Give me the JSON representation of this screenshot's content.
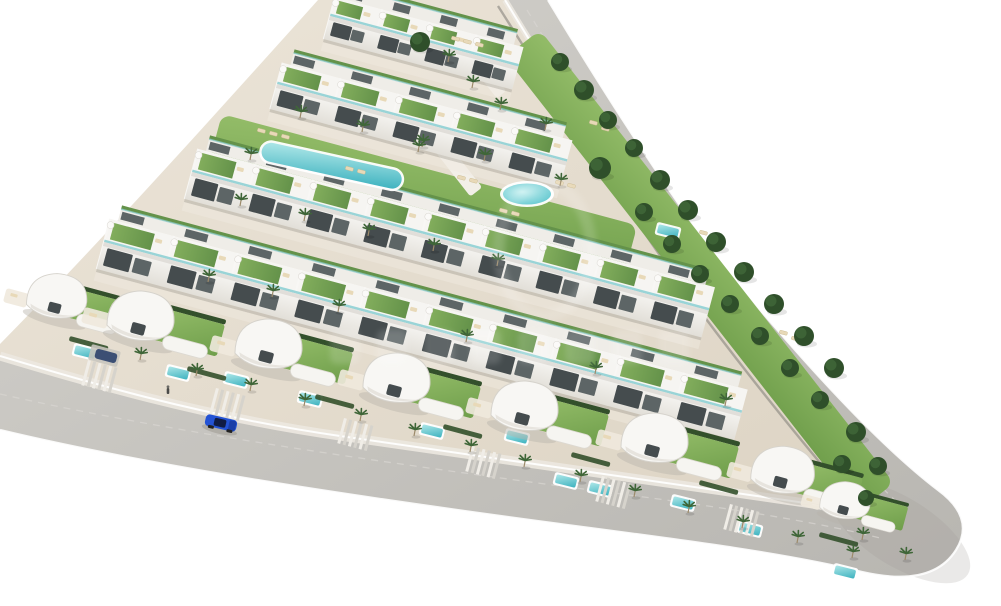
{
  "scene": {
    "description": "Aerial 3D architectural render of a triangular coastal residential development: stepped rows of white townhouses with green roof terraces and glass balustrades, a curved communal lap pool and a round pool on lawns, curvy white detached villas with private pools along the lower rows, palm trees, dense green trees along the upper perimeter road, two gray roads meeting at a rounded eastern tip, one blue car driving on the lower road, faint illegible watermark in the center.",
    "background": "#ffffff",
    "width": 1001,
    "height": 606
  },
  "colors": {
    "sand1": "#ece5d9",
    "sand2": "#ddd4c4",
    "road1": "#d4d2cd",
    "road2": "#b8b6b1",
    "roadDash": "#d8d6d1",
    "curb": "#ffffff",
    "sidewalk": "#ece8e0",
    "wallShadow": "#8d8a83",
    "tipShade": "#9f9d98",
    "building": "#f6f5f2",
    "buildingShade": "#e6e3dd",
    "buildingBack": "#efede8",
    "buildingDark": "#c9c6bf",
    "window": "#454c4e",
    "windowLight": "#5d6566",
    "glass": "#8fd0d4",
    "roofGreen1": "#82ad5c",
    "roofGreen2": "#64924a",
    "lawn1": "#93bc68",
    "lawn2": "#6f9e4b",
    "hedge": "#33502b",
    "palm": "#3f6638",
    "palmTrunk": "#9c8a6a",
    "treeDark": "#2f4f2a",
    "treeLite": "#41683a",
    "pool1": "#aee7e8",
    "pool2": "#3db2bf",
    "poolRim": "#ffffff",
    "lounger": "#e8d9b8",
    "path": "#f2efe8",
    "carBlue": "#2453d4",
    "carHood": "#1b3fa8",
    "carGlass": "#101c45",
    "parkedCar": "#3c4f74",
    "figure": "#4a4a48",
    "shadow": "#b9b4aa",
    "watermark": "#ffffff"
  },
  "ground": {
    "d": "M318,0 L512,0 C566,92 628,196 692,288 C762,382 832,468 872,516 C760,498 560,470 340,438 C200,418 80,382 0,358 L0,344 C106,236 212,118 318,0 Z"
  },
  "road": {
    "band": "M505,0 C560,90 625,195 690,285 C760,380 830,468 868,512 C780,498 560,468 340,436 C200,416 80,380 0,356 L0,430 C150,466 350,496 560,524 C690,541 790,554 862,572 Q932,588 956,550 Q976,518 938,490 C870,438 792,348 726,270 C662,184 600,86 548,0 Z",
    "innerTop": "M505,0 C560,90 625,195 690,285 C760,380 830,468 868,512",
    "innerBottom": "M868,512 C780,498 560,468 340,436 C200,416 80,380 0,356",
    "outer": "M548,0 C600,86 662,184 726,270 C792,348 870,438 938,490 Q976,518 956,550 Q932,588 862,572 C790,554 690,541 560,524 C350,496 150,466 0,430",
    "wallShadow": "M498,6 C554,94 618,198 683,288 C752,382 822,466 860,510",
    "dashTop": "M527,10 C585,105 645,205 708,288 C770,370 840,448 900,505",
    "dashBottom": "M0,394 C150,428 350,458 560,486 C700,504 800,518 880,538",
    "tip": {
      "x": 900,
      "y": 532,
      "rx": 80,
      "ry": 34,
      "angle": 32
    }
  },
  "lawns": [
    {
      "x": 540,
      "y": 30,
      "angle": 52,
      "w": 575,
      "h": 44
    },
    {
      "x": 222,
      "y": 114,
      "angle": 15,
      "w": 430,
      "h": 62
    }
  ],
  "walkways": [
    {
      "x": 428,
      "y": 118,
      "angle": 52,
      "w": 88,
      "h": 15
    },
    {
      "x": 468,
      "y": 42,
      "angle": 52,
      "w": 62,
      "h": 12
    }
  ],
  "rows": [
    {
      "x": 330,
      "y": 16,
      "angle": 15,
      "len": 195,
      "units": 4,
      "fH": 24,
      "rD": 20,
      "upper": true
    },
    {
      "x": 277,
      "y": 84,
      "angle": 15,
      "len": 300,
      "units": 5,
      "fH": 26,
      "rD": 22,
      "upper": true
    },
    {
      "x": 192,
      "y": 172,
      "angle": 15,
      "len": 535,
      "units": 9,
      "fH": 28,
      "rD": 24,
      "upper": true
    },
    {
      "x": 104,
      "y": 242,
      "angle": 15,
      "len": 660,
      "units": 10,
      "fH": 28,
      "rD": 24,
      "upper": true
    }
  ],
  "villas": [
    {
      "x": 58,
      "y": 298,
      "s": 0.9
    },
    {
      "x": 142,
      "y": 318,
      "s": 1.0
    },
    {
      "x": 270,
      "y": 346,
      "s": 1.0
    },
    {
      "x": 398,
      "y": 380,
      "s": 1.0
    },
    {
      "x": 526,
      "y": 408,
      "s": 1.0
    },
    {
      "x": 656,
      "y": 440,
      "s": 1.0
    },
    {
      "x": 784,
      "y": 472,
      "s": 0.95
    },
    {
      "x": 846,
      "y": 502,
      "s": 0.75
    }
  ],
  "driveways": [
    {
      "x": 88,
      "y": 360
    },
    {
      "x": 216,
      "y": 388
    },
    {
      "x": 344,
      "y": 418
    },
    {
      "x": 472,
      "y": 446
    },
    {
      "x": 602,
      "y": 476
    },
    {
      "x": 730,
      "y": 504
    }
  ],
  "hedges": [
    {
      "x": 70,
      "y": 336
    },
    {
      "x": 188,
      "y": 366
    },
    {
      "x": 316,
      "y": 394
    },
    {
      "x": 444,
      "y": 424
    },
    {
      "x": 572,
      "y": 452
    },
    {
      "x": 700,
      "y": 480
    },
    {
      "x": 820,
      "y": 532
    }
  ],
  "pools": {
    "lap": {
      "x": 262,
      "y": 138,
      "angle": 12.5,
      "len": 148,
      "w": 24
    },
    "round": {
      "x": 527,
      "y": 194,
      "rx": 27,
      "ry": 13
    },
    "small": [
      {
        "x": 85,
        "y": 352
      },
      {
        "x": 178,
        "y": 373
      },
      {
        "x": 236,
        "y": 380
      },
      {
        "x": 310,
        "y": 399
      },
      {
        "x": 432,
        "y": 431
      },
      {
        "x": 517,
        "y": 437
      },
      {
        "x": 566,
        "y": 481
      },
      {
        "x": 600,
        "y": 489
      },
      {
        "x": 683,
        "y": 503
      },
      {
        "x": 750,
        "y": 529
      },
      {
        "x": 845,
        "y": 572
      },
      {
        "x": 668,
        "y": 231
      }
    ]
  },
  "loungers": [
    {
      "x": 258,
      "y": 128
    },
    {
      "x": 270,
      "y": 131
    },
    {
      "x": 282,
      "y": 134
    },
    {
      "x": 346,
      "y": 166
    },
    {
      "x": 358,
      "y": 169
    },
    {
      "x": 458,
      "y": 175
    },
    {
      "x": 470,
      "y": 178
    },
    {
      "x": 556,
      "y": 180
    },
    {
      "x": 568,
      "y": 183
    },
    {
      "x": 500,
      "y": 208
    },
    {
      "x": 512,
      "y": 211
    },
    {
      "x": 452,
      "y": 36
    },
    {
      "x": 464,
      "y": 39
    },
    {
      "x": 476,
      "y": 42
    },
    {
      "x": 590,
      "y": 120
    },
    {
      "x": 602,
      "y": 126
    },
    {
      "x": 700,
      "y": 230
    },
    {
      "x": 712,
      "y": 236
    },
    {
      "x": 780,
      "y": 330
    },
    {
      "x": 792,
      "y": 336
    }
  ],
  "palms": [
    {
      "x": 300,
      "y": 118
    },
    {
      "x": 362,
      "y": 132
    },
    {
      "x": 422,
      "y": 147
    },
    {
      "x": 484,
      "y": 161
    },
    {
      "x": 545,
      "y": 130
    },
    {
      "x": 240,
      "y": 206
    },
    {
      "x": 304,
      "y": 221
    },
    {
      "x": 368,
      "y": 236
    },
    {
      "x": 433,
      "y": 251
    },
    {
      "x": 497,
      "y": 266
    },
    {
      "x": 208,
      "y": 282
    },
    {
      "x": 272,
      "y": 297
    },
    {
      "x": 338,
      "y": 312
    },
    {
      "x": 466,
      "y": 342
    },
    {
      "x": 595,
      "y": 374
    },
    {
      "x": 725,
      "y": 406
    },
    {
      "x": 140,
      "y": 360
    },
    {
      "x": 196,
      "y": 376
    },
    {
      "x": 250,
      "y": 391
    },
    {
      "x": 304,
      "y": 406
    },
    {
      "x": 360,
      "y": 421
    },
    {
      "x": 414,
      "y": 436
    },
    {
      "x": 470,
      "y": 452
    },
    {
      "x": 524,
      "y": 467
    },
    {
      "x": 580,
      "y": 482
    },
    {
      "x": 634,
      "y": 497
    },
    {
      "x": 688,
      "y": 513
    },
    {
      "x": 742,
      "y": 528
    },
    {
      "x": 797,
      "y": 543
    },
    {
      "x": 852,
      "y": 558
    },
    {
      "x": 448,
      "y": 62
    },
    {
      "x": 472,
      "y": 88
    },
    {
      "x": 500,
      "y": 110
    },
    {
      "x": 250,
      "y": 160
    },
    {
      "x": 418,
      "y": 152
    },
    {
      "x": 560,
      "y": 186
    },
    {
      "x": 905,
      "y": 560
    },
    {
      "x": 862,
      "y": 540
    }
  ],
  "trees": [
    {
      "x": 560,
      "y": 62,
      "r": 9
    },
    {
      "x": 584,
      "y": 90,
      "r": 10
    },
    {
      "x": 608,
      "y": 120,
      "r": 9
    },
    {
      "x": 600,
      "y": 168,
      "r": 11
    },
    {
      "x": 634,
      "y": 148,
      "r": 9
    },
    {
      "x": 660,
      "y": 180,
      "r": 10
    },
    {
      "x": 644,
      "y": 212,
      "r": 9
    },
    {
      "x": 688,
      "y": 210,
      "r": 10
    },
    {
      "x": 672,
      "y": 244,
      "r": 9
    },
    {
      "x": 716,
      "y": 242,
      "r": 10
    },
    {
      "x": 700,
      "y": 274,
      "r": 9
    },
    {
      "x": 744,
      "y": 272,
      "r": 10
    },
    {
      "x": 730,
      "y": 304,
      "r": 9
    },
    {
      "x": 774,
      "y": 304,
      "r": 10
    },
    {
      "x": 760,
      "y": 336,
      "r": 9
    },
    {
      "x": 804,
      "y": 336,
      "r": 10
    },
    {
      "x": 790,
      "y": 368,
      "r": 9
    },
    {
      "x": 834,
      "y": 368,
      "r": 10
    },
    {
      "x": 820,
      "y": 400,
      "r": 9
    },
    {
      "x": 856,
      "y": 432,
      "r": 10
    },
    {
      "x": 842,
      "y": 464,
      "r": 9
    },
    {
      "x": 878,
      "y": 466,
      "r": 9
    },
    {
      "x": 866,
      "y": 498,
      "r": 8
    },
    {
      "x": 420,
      "y": 42,
      "r": 10
    }
  ],
  "vehicles": {
    "car": {
      "x": 221,
      "y": 423,
      "angle": 13
    },
    "parked": {
      "x": 106,
      "y": 356,
      "angle": 15
    },
    "carport": {
      "x": 92,
      "y": 344,
      "angle": 15,
      "w": 30,
      "h": 16
    }
  },
  "pedestrian": {
    "x": 168,
    "y": 392
  },
  "watermark": {
    "visible": true,
    "legible": false,
    "opacity": 0.14,
    "shield": {
      "x": 545,
      "y": 250,
      "rx": 46,
      "ry": 66
    },
    "bars": {
      "y": 330,
      "x0": 330,
      "step": 47,
      "count": 8,
      "w": 30,
      "h": 34
    }
  }
}
